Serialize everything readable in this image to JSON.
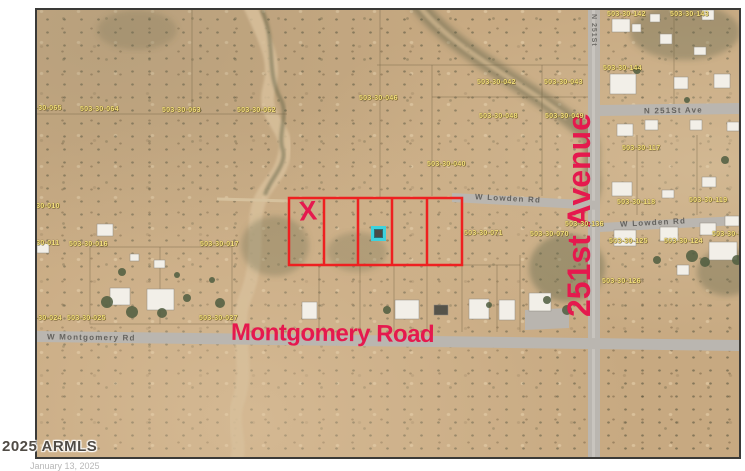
{
  "map": {
    "watermark": "2025 ARMLS",
    "footer_partial_left": "January 13, 2025",
    "overlays": {
      "montgomery_label": "Montgomery Road",
      "avenue_label": "251st Avenue",
      "x_marker": "X"
    },
    "road_labels": {
      "w_montgomery": "W  Montgomery  Rd",
      "w_lowden_west": "W  Lowden  Rd",
      "w_lowden_east": "W  Lowden  Rd",
      "n_251st_ave": "N  251St  Ave",
      "n_251st_vertical": "N 251St"
    },
    "colors": {
      "highlight_red": "#e5194e",
      "parcel_outline_red": "#ee2020",
      "marker_cyan": "#3dd2dd",
      "parcel_number_yellow": "#f5e17d",
      "road_gray": "#bab6b0",
      "terrain_tan": "#c7a981"
    },
    "parcel_labels": [
      "503-30-065",
      "503-30-064",
      "503-30-063",
      "503-30-062",
      "503-30-046",
      "503-30-042",
      "503-30-043",
      "503-30-048",
      "503-30-049",
      "503-30-040",
      "503-30-142",
      "503-30-143",
      "503-30-144",
      "503-30-117",
      "503-30-118",
      "503-30-119",
      "503-30-136",
      "503-30-071",
      "503-30-070",
      "503-30-125",
      "503-30-124",
      "503-30-123",
      "503-30-126",
      "503-30-010",
      "503-30-011",
      "503-30-016",
      "503-30-017",
      "503-30-024",
      "503-30-025",
      "503-30-027"
    ]
  }
}
